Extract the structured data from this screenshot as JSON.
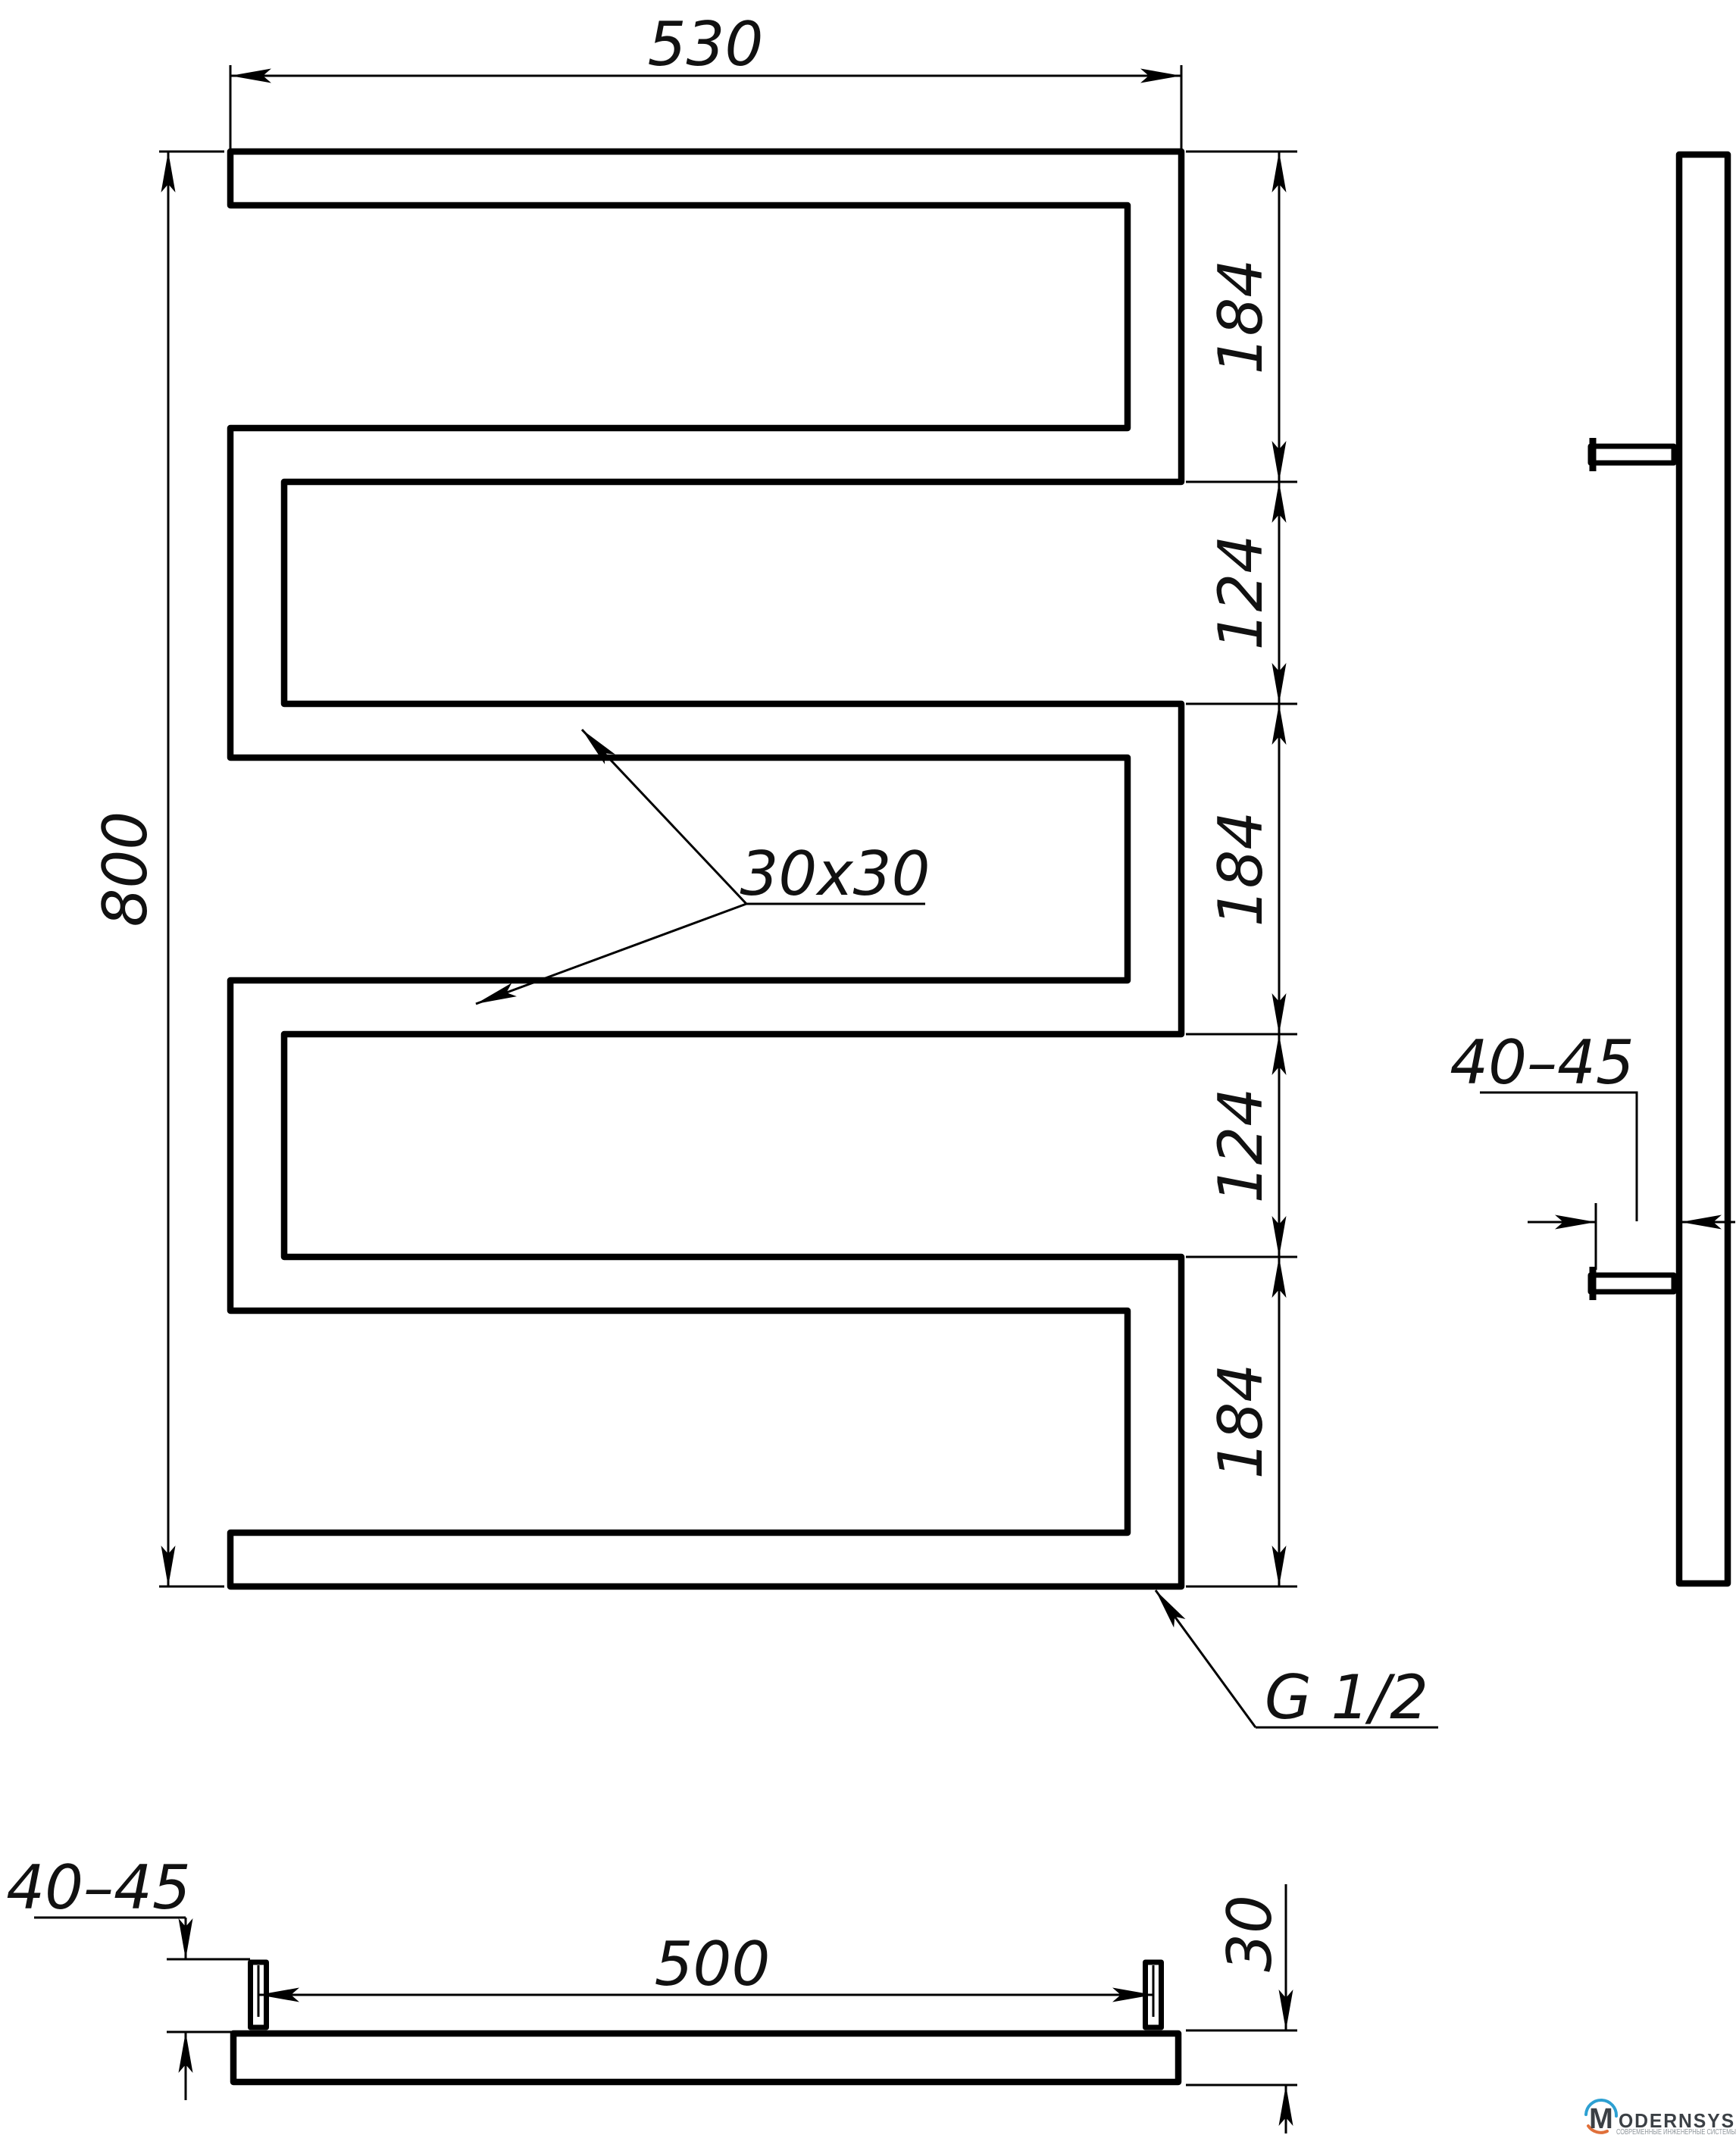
{
  "views": {
    "front": {
      "width_dim": "530",
      "height_dim": "800",
      "segment_dims": [
        "184",
        "124",
        "184",
        "124",
        "184"
      ],
      "tube_profile_label": "30x30",
      "thread_label": "G 1/2"
    },
    "side": {
      "bracket_depth_dim": "40–45"
    },
    "bottom": {
      "bracket_height_dim": "40–45",
      "bracket_centers_dim": "500",
      "tube_depth_dim": "30"
    }
  },
  "logo": {
    "monogram": "M",
    "wordmark": "MODERNSYS",
    "wordmark_rest": "ODERNSYS",
    "tagline": "СОВРЕМЕННЫЕ ИНЖЕНЕРНЫЕ СИСТЕМЫ",
    "colors": {
      "blue": "#2da0d2",
      "orange": "#e0703a",
      "text": "#3b4045",
      "tagline": "#8f969b"
    }
  },
  "drawing": {
    "line_color": "#000000",
    "background": "#ffffff"
  }
}
